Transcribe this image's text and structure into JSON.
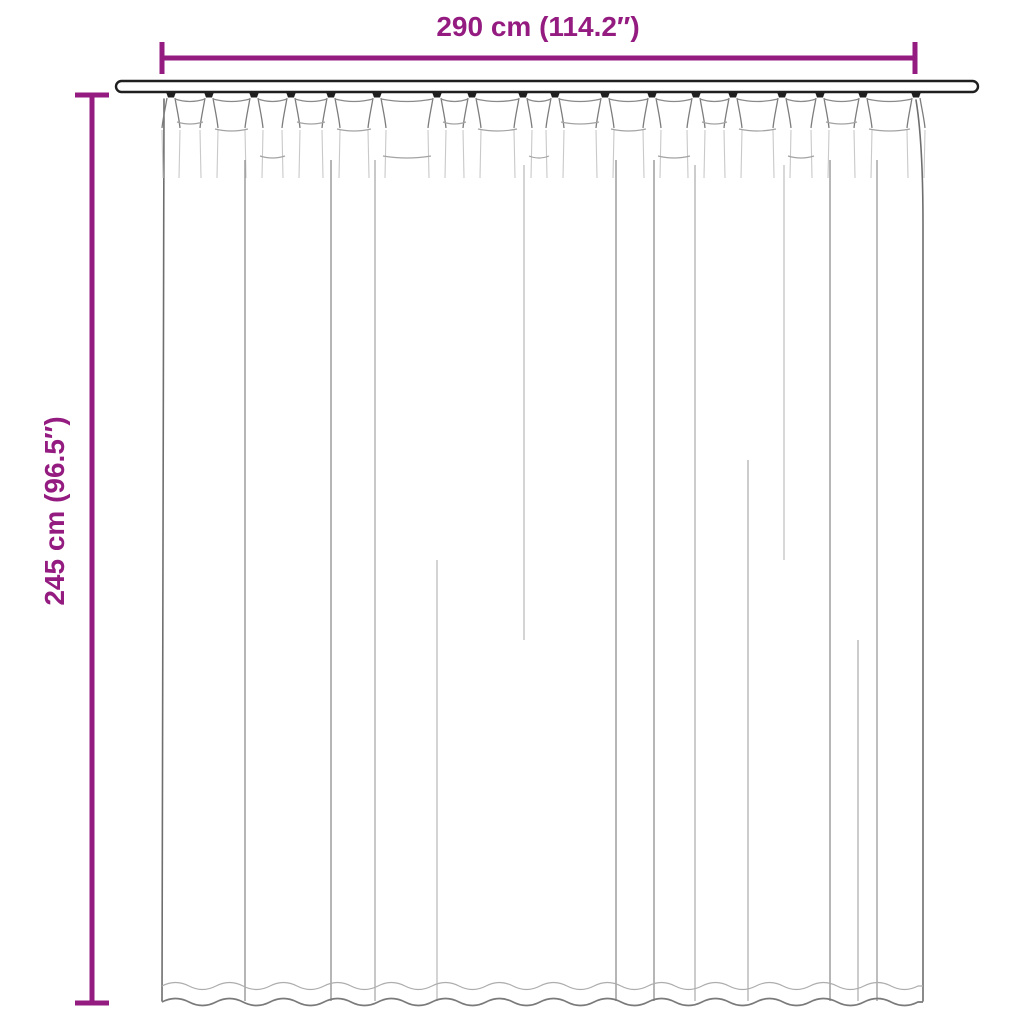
{
  "diagram": {
    "width_label": "290 cm (114.2″)",
    "height_label": "245 cm (96.5″)",
    "colors": {
      "accent": "#941b80",
      "line_dark": "#1f1f1f",
      "outline": "#6e6e6e",
      "fold": "#9b9b9b",
      "background": "#ffffff"
    }
  }
}
